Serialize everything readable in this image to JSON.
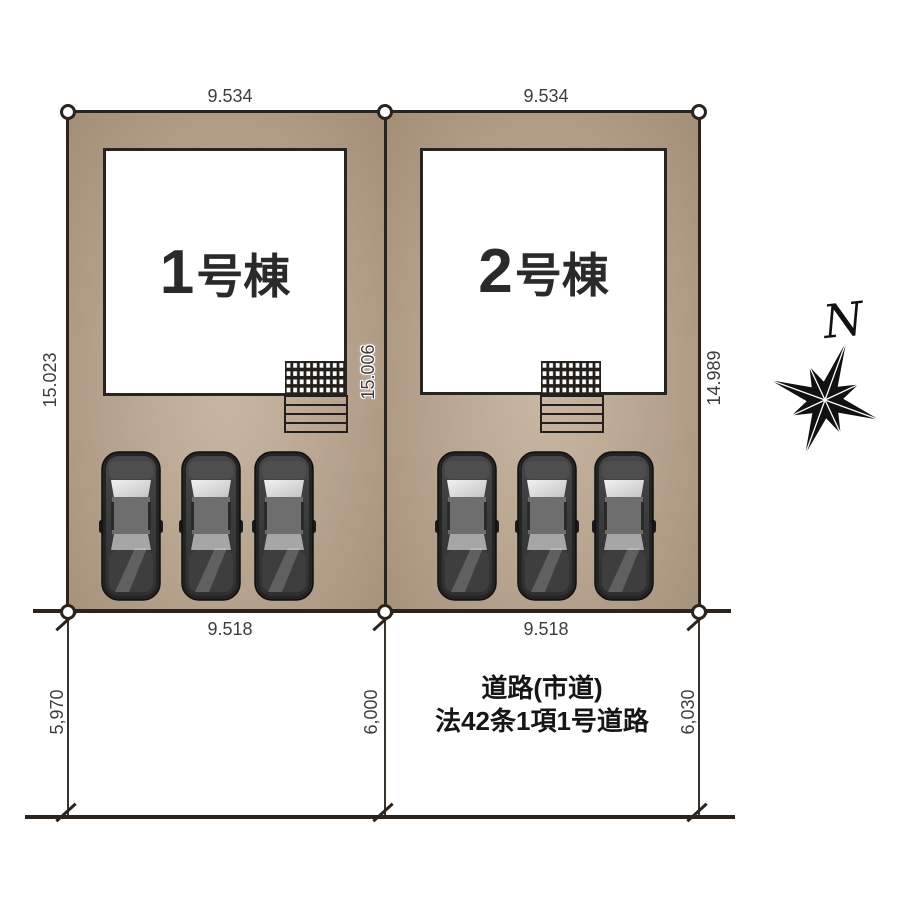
{
  "site_plan": {
    "plots": [
      {
        "id": "plot-1",
        "building_number": "1",
        "building_suffix": "号棟",
        "top_dim": "9.534",
        "bottom_dim": "9.518",
        "side_dim": "15.023"
      },
      {
        "id": "plot-2",
        "building_number": "2",
        "building_suffix": "号棟",
        "top_dim": "9.534",
        "bottom_dim": "9.518",
        "side_dim": "14.989"
      }
    ],
    "center_side_dim": "15.006",
    "road": {
      "name_line1": "道路(市道)",
      "name_line2": "法42条1項1号道路",
      "width_left": "5,970",
      "width_center": "6,000",
      "width_right": "6,030"
    },
    "compass": {
      "label": "N"
    },
    "colors": {
      "plot_fill_center": "#c8b8a3",
      "plot_fill_edge": "#a38e76",
      "line": "#2b241e",
      "car_body": "#2b2b2b",
      "background": "#ffffff"
    },
    "cars_per_plot": 3
  }
}
